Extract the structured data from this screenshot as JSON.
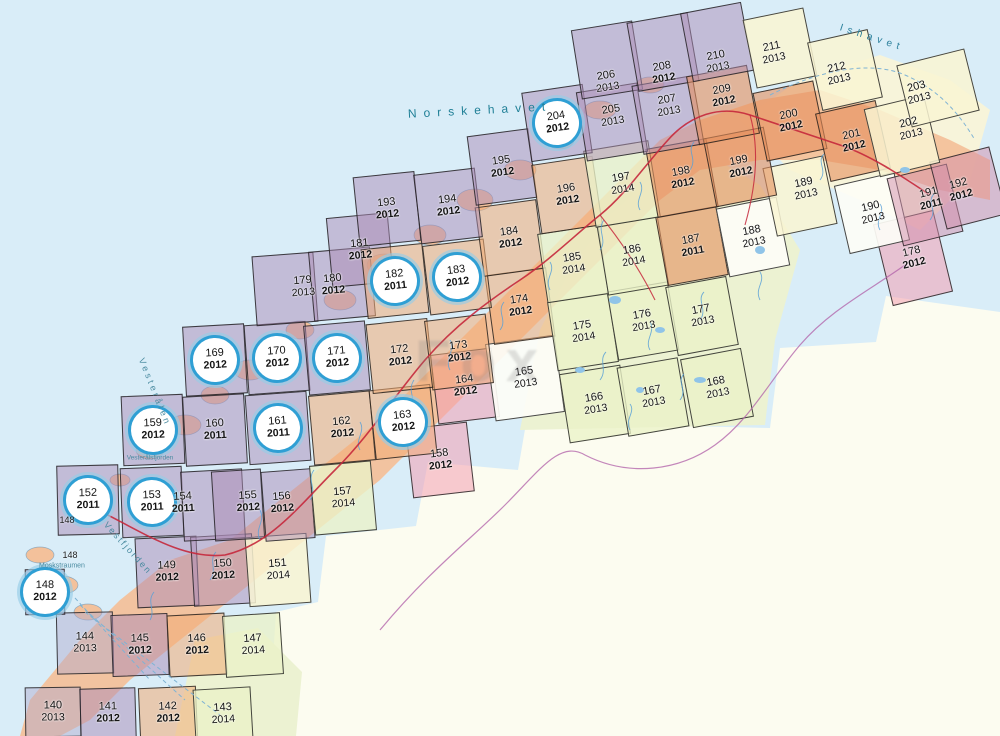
{
  "watermark": {
    "text": "Fox"
  },
  "fills": {
    "purple": "rgba(172,139,181,0.50)",
    "purpleBlue": "rgba(176,168,205,0.45)",
    "orange": "rgba(242,172,117,0.55)",
    "brown": "rgba(228,142,92,0.60)",
    "green": "rgba(234,242,200,0.78)",
    "yellow": "rgba(249,244,210,0.85)",
    "white": "rgba(253,253,246,0.92)",
    "pink": "rgba(242,158,178,0.55)",
    "mauve": "rgba(210,140,170,0.50)"
  },
  "accent_colors": {
    "circle_ring": "#2f9fd4",
    "road_red": "#c5283c",
    "border_violet": "#b05fa8",
    "water_blue": "#58a0d8",
    "sea": "#d9edf8",
    "sea_text": "#1f7f96"
  },
  "sheets": [
    {
      "num": "140",
      "year": "2013",
      "x": 53,
      "y": 712,
      "fill": "purpleBlue",
      "w": 56,
      "h": 50
    },
    {
      "num": "141",
      "year": "2012",
      "x": 108,
      "y": 713,
      "fill": "purple",
      "w": 56,
      "h": 50
    },
    {
      "num": "142",
      "year": "2012",
      "x": 168,
      "y": 713,
      "fill": "orange",
      "w": 58,
      "h": 52
    },
    {
      "num": "143",
      "year": "2014",
      "x": 223,
      "y": 714,
      "fill": "green",
      "w": 58,
      "h": 52
    },
    {
      "num": "144",
      "year": "2013",
      "x": 85,
      "y": 643,
      "fill": "purpleBlue",
      "w": 57,
      "h": 62
    },
    {
      "num": "145",
      "year": "2012",
      "x": 140,
      "y": 645,
      "fill": "purple",
      "w": 57,
      "h": 62
    },
    {
      "num": "146",
      "year": "2012",
      "x": 197,
      "y": 645,
      "fill": "orange",
      "w": 58,
      "h": 62
    },
    {
      "num": "147",
      "year": "2014",
      "x": 253,
      "y": 645,
      "fill": "green",
      "w": 58,
      "h": 62
    },
    {
      "num": "148",
      "year": "2012",
      "x": 45,
      "y": 592,
      "fill": "purple",
      "circled": true,
      "w": 40,
      "h": 46
    },
    {
      "num": "149",
      "year": "2012",
      "x": 167,
      "y": 572,
      "fill": "purple"
    },
    {
      "num": "150",
      "year": "2012",
      "x": 223,
      "y": 570,
      "fill": "purple"
    },
    {
      "num": "151",
      "year": "2014",
      "x": 278,
      "y": 570,
      "fill": "yellow"
    },
    {
      "num": "152",
      "year": "2011",
      "x": 88,
      "y": 500,
      "fill": "purple",
      "circled": true
    },
    {
      "num": "153",
      "year": "2011",
      "x": 152,
      "y": 502,
      "fill": "purple",
      "circled": true
    },
    {
      "num": "154",
      "year": "2011",
      "x": 183,
      "y": 503,
      "bx": 213,
      "by": 505,
      "fill": "purple"
    },
    {
      "num": "155",
      "year": "2012",
      "x": 248,
      "y": 502,
      "bx": 238,
      "by": 505,
      "w": 50,
      "fill": "purple"
    },
    {
      "num": "156",
      "year": "2012",
      "x": 282,
      "y": 503,
      "bx": 288,
      "by": 505,
      "w": 50,
      "fill": "purple"
    },
    {
      "num": "157",
      "year": "2014",
      "x": 343,
      "y": 498,
      "fill": "green"
    },
    {
      "num": "158",
      "year": "2012",
      "x": 440,
      "y": 460,
      "fill": "pink"
    },
    {
      "num": "159",
      "year": "2012",
      "x": 153,
      "y": 430,
      "fill": "purple",
      "circled": true
    },
    {
      "num": "160",
      "year": "2011",
      "x": 215,
      "y": 430,
      "fill": "purple"
    },
    {
      "num": "161",
      "year": "2011",
      "x": 278,
      "y": 428,
      "fill": "purple",
      "circled": true
    },
    {
      "num": "162",
      "year": "2012",
      "x": 342,
      "y": 428,
      "fill": "orange"
    },
    {
      "num": "163",
      "year": "2012",
      "x": 403,
      "y": 422,
      "fill": "orange",
      "circled": true
    },
    {
      "num": "164",
      "year": "2012",
      "x": 465,
      "y": 386,
      "fill": "pink"
    },
    {
      "num": "165",
      "year": "2013",
      "x": 525,
      "y": 378,
      "fill": "white",
      "w": 70,
      "h": 78
    },
    {
      "num": "166",
      "year": "2013",
      "x": 595,
      "y": 404,
      "fill": "green"
    },
    {
      "num": "167",
      "year": "2013",
      "x": 653,
      "y": 397,
      "fill": "green"
    },
    {
      "num": "168",
      "year": "2013",
      "x": 717,
      "y": 388,
      "fill": "green"
    },
    {
      "num": "169",
      "year": "2012",
      "x": 215,
      "y": 360,
      "fill": "purple",
      "circled": true
    },
    {
      "num": "170",
      "year": "2012",
      "x": 277,
      "y": 358,
      "fill": "purple",
      "circled": true
    },
    {
      "num": "171",
      "year": "2012",
      "x": 337,
      "y": 358,
      "fill": "purple",
      "circled": true
    },
    {
      "num": "172",
      "year": "2012",
      "x": 400,
      "y": 356,
      "fill": "orange"
    },
    {
      "num": "173",
      "year": "2012",
      "x": 459,
      "y": 352,
      "fill": "orange"
    },
    {
      "num": "174",
      "year": "2012",
      "x": 520,
      "y": 306,
      "fill": "orange"
    },
    {
      "num": "175",
      "year": "2014",
      "x": 583,
      "y": 332,
      "fill": "green"
    },
    {
      "num": "176",
      "year": "2013",
      "x": 643,
      "y": 321,
      "fill": "green"
    },
    {
      "num": "177",
      "year": "2013",
      "x": 702,
      "y": 316,
      "fill": "green"
    },
    {
      "num": "178",
      "year": "2012",
      "x": 913,
      "y": 258,
      "fill": "pink",
      "h": 84
    },
    {
      "num": "179",
      "year": "2013",
      "x": 303,
      "y": 287,
      "bx": 285,
      "by": 289,
      "fill": "purple"
    },
    {
      "num": "180",
      "year": "2012",
      "x": 333,
      "y": 285,
      "bx": 342,
      "by": 284,
      "fill": "purple"
    },
    {
      "num": "181",
      "year": "2012",
      "x": 360,
      "y": 250,
      "fill": "purple"
    },
    {
      "num": "182",
      "year": "2011",
      "x": 395,
      "y": 281,
      "fill": "orange",
      "circled": true
    },
    {
      "num": "183",
      "year": "2012",
      "x": 457,
      "y": 277,
      "fill": "orange",
      "circled": true
    },
    {
      "num": "184",
      "year": "2012",
      "x": 510,
      "y": 238,
      "fill": "orange"
    },
    {
      "num": "185",
      "year": "2014",
      "x": 573,
      "y": 264,
      "fill": "green"
    },
    {
      "num": "186",
      "year": "2014",
      "x": 633,
      "y": 256,
      "fill": "green"
    },
    {
      "num": "187",
      "year": "2011",
      "x": 692,
      "y": 246,
      "fill": "brown"
    },
    {
      "num": "188",
      "year": "2013",
      "x": 753,
      "y": 237,
      "fill": "white"
    },
    {
      "num": "189",
      "year": "2013",
      "x": 805,
      "y": 189,
      "bx": 800,
      "by": 196,
      "fill": "yellow"
    },
    {
      "num": "190",
      "year": "2013",
      "x": 872,
      "y": 213,
      "fill": "white"
    },
    {
      "num": "191",
      "year": "2011",
      "x": 930,
      "y": 199,
      "bx": 925,
      "by": 205,
      "fill": "mauve"
    },
    {
      "num": "192",
      "year": "2012",
      "x": 960,
      "y": 190,
      "bx": 968,
      "by": 188,
      "fill": "mauve"
    },
    {
      "num": "193",
      "year": "2012",
      "x": 387,
      "y": 209,
      "fill": "purple"
    },
    {
      "num": "194",
      "year": "2012",
      "x": 448,
      "y": 206,
      "fill": "purple"
    },
    {
      "num": "195",
      "year": "2012",
      "x": 502,
      "y": 167,
      "fill": "purple"
    },
    {
      "num": "196",
      "year": "2012",
      "x": 567,
      "y": 195,
      "fill": "orange"
    },
    {
      "num": "197",
      "year": "2014",
      "x": 622,
      "y": 184,
      "fill": "green",
      "w": 66,
      "h": 78
    },
    {
      "num": "198",
      "year": "2012",
      "x": 682,
      "y": 178,
      "fill": "brown"
    },
    {
      "num": "199",
      "year": "2012",
      "x": 740,
      "y": 167,
      "fill": "brown"
    },
    {
      "num": "200",
      "year": "2012",
      "x": 790,
      "y": 121,
      "fill": "brown"
    },
    {
      "num": "201",
      "year": "2012",
      "x": 853,
      "y": 141,
      "fill": "brown"
    },
    {
      "num": "202",
      "year": "2013",
      "x": 910,
      "y": 129,
      "bx": 902,
      "by": 136,
      "fill": "yellow"
    },
    {
      "num": "203",
      "year": "2013",
      "x": 918,
      "y": 93,
      "bx": 938,
      "by": 88,
      "w": 70,
      "h": 64,
      "fill": "yellow"
    },
    {
      "num": "204",
      "year": "2012",
      "x": 557,
      "y": 123,
      "fill": "purple",
      "circled": true
    },
    {
      "num": "205",
      "year": "2013",
      "x": 612,
      "y": 116,
      "bx": 612,
      "by": 122,
      "fill": "purple"
    },
    {
      "num": "206",
      "year": "2013",
      "x": 607,
      "y": 82,
      "bx": 607,
      "by": 60,
      "fill": "purple"
    },
    {
      "num": "207",
      "year": "2013",
      "x": 668,
      "y": 106,
      "bx": 668,
      "by": 115,
      "fill": "purple"
    },
    {
      "num": "208",
      "year": "2012",
      "x": 663,
      "y": 73,
      "bx": 663,
      "by": 52,
      "fill": "purple"
    },
    {
      "num": "209",
      "year": "2012",
      "x": 723,
      "y": 96,
      "bx": 723,
      "by": 105,
      "fill": "brown"
    },
    {
      "num": "210",
      "year": "2013",
      "x": 717,
      "y": 62,
      "bx": 717,
      "by": 42,
      "fill": "purple"
    },
    {
      "num": "211",
      "year": "2013",
      "x": 773,
      "y": 53,
      "bx": 780,
      "by": 48,
      "fill": "yellow"
    },
    {
      "num": "212",
      "year": "2013",
      "x": 838,
      "y": 74,
      "bx": 845,
      "by": 70,
      "fill": "yellow"
    }
  ],
  "extra_labels": [
    {
      "text": "148",
      "x": 67,
      "y": 520
    },
    {
      "text": "148",
      "x": 70,
      "y": 555
    }
  ],
  "sea_labels": [
    {
      "text": "Norskehavet",
      "x": 480,
      "y": 110,
      "rot": -3,
      "size": 12,
      "ls": 7,
      "color": "#1f7f96"
    },
    {
      "text": "Ishavet",
      "x": 872,
      "y": 38,
      "rot": 18,
      "size": 10,
      "ls": 5,
      "color": "#2a7f9b"
    },
    {
      "text": "Vesterålen",
      "x": 155,
      "y": 392,
      "rot": 68,
      "size": 9,
      "ls": 3,
      "color": "#4a8ba0"
    },
    {
      "text": "Vestfjorden",
      "x": 128,
      "y": 548,
      "rot": 48,
      "size": 9,
      "ls": 2,
      "color": "#4a8ba0"
    },
    {
      "text": "Moskstraumen",
      "x": 62,
      "y": 566,
      "rot": 0,
      "size": 7,
      "ls": 0,
      "color": "#4a8ba0"
    },
    {
      "text": "Vesterålsfjorden",
      "x": 150,
      "y": 458,
      "rot": 0,
      "size": 6.5,
      "ls": 0,
      "color": "#4a8ba0"
    }
  ]
}
